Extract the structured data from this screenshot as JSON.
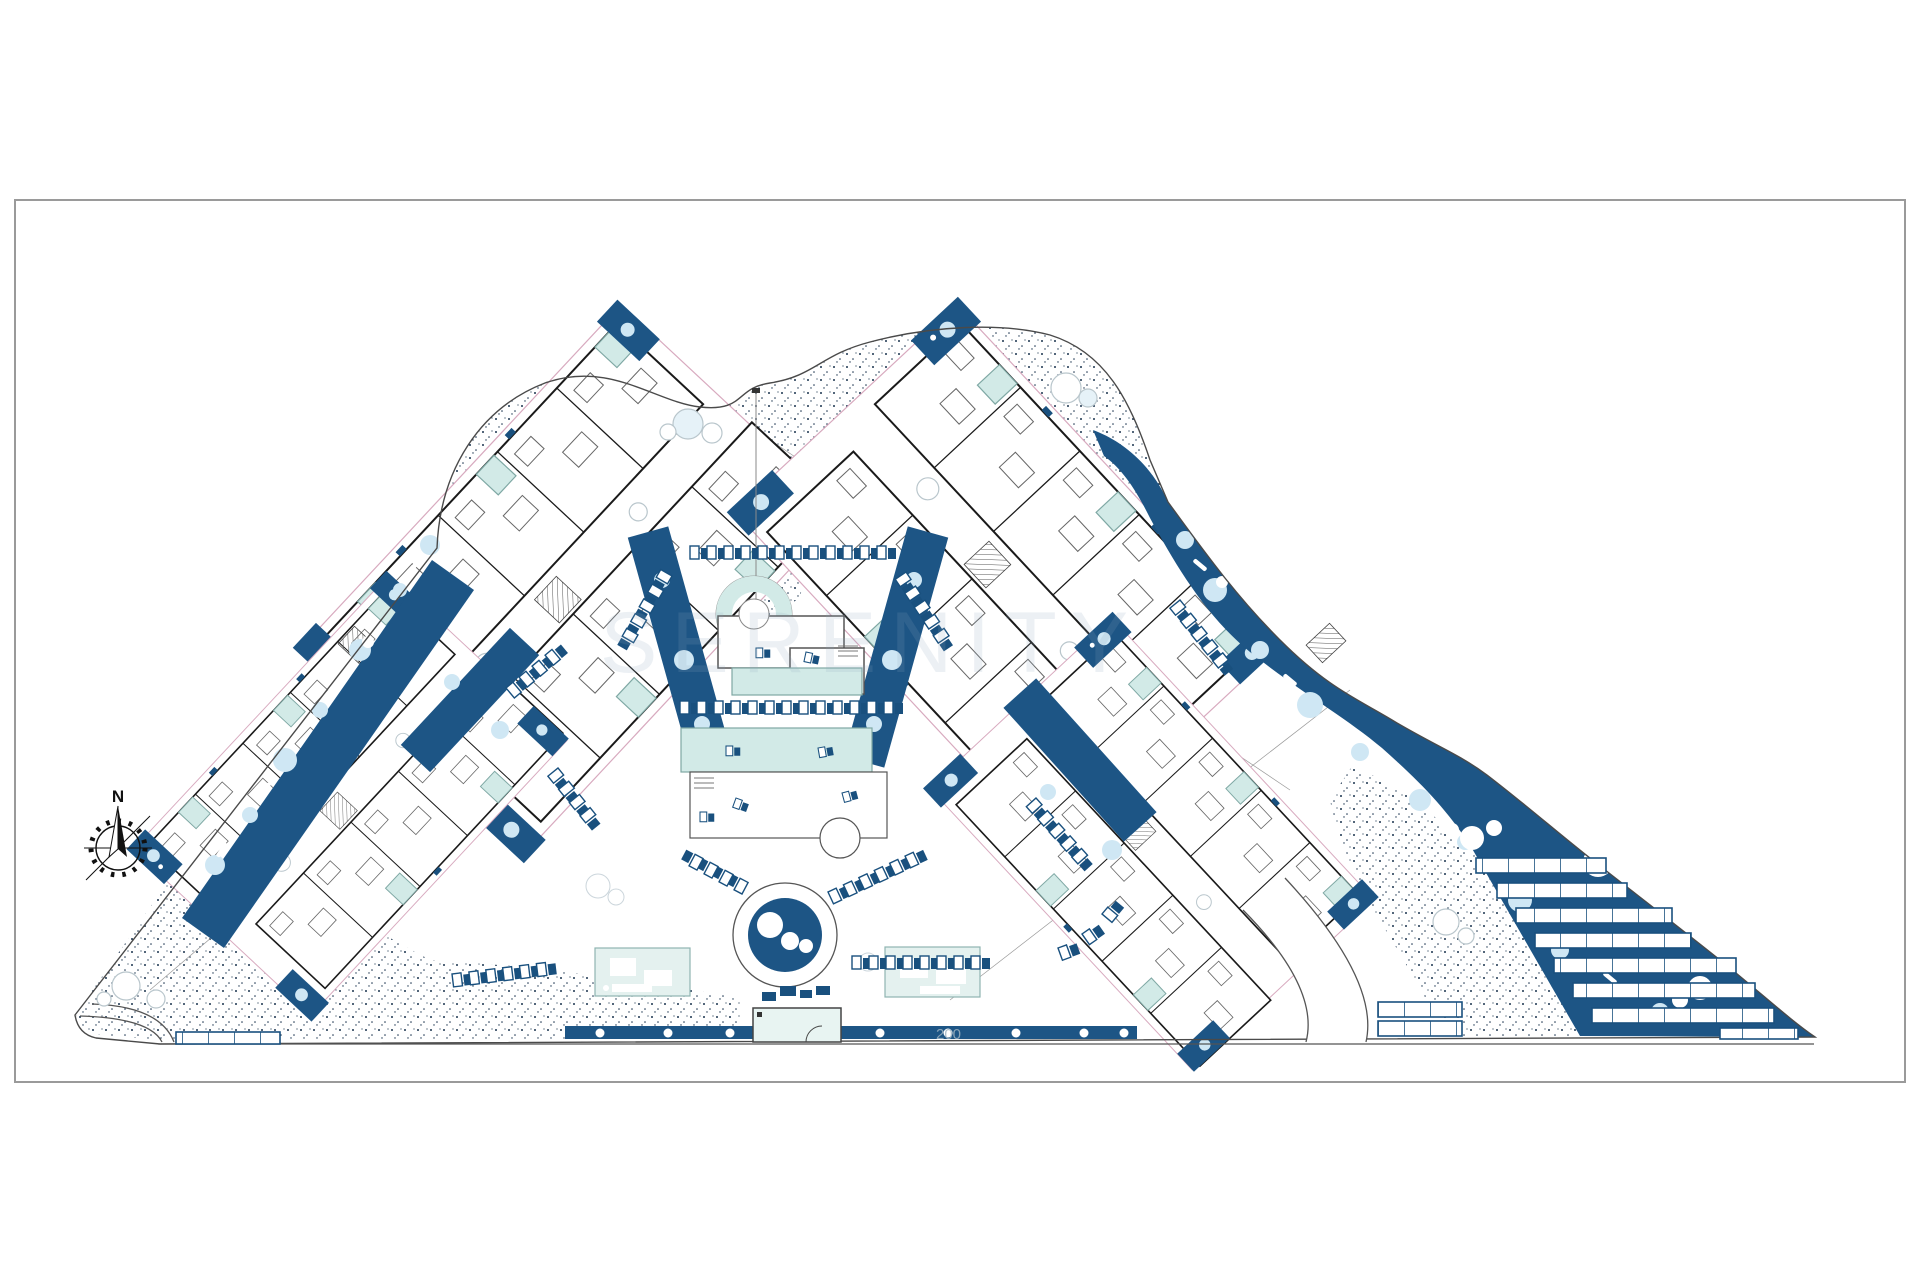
{
  "sheet": {
    "compass_label": "N",
    "watermark": "SERENITY",
    "road_marker": "200"
  },
  "colors": {
    "paper": "#ffffff",
    "border": "#9a9a9a",
    "ink": "#1a1a1a",
    "terrace": "#d8aabf",
    "blue": "#1d5585",
    "blue_deep": "#19507e",
    "shrub": "#cfe7f4",
    "pool": "#d2eae7",
    "pool_edge": "#7fa8a4",
    "stipple": "#1c3550",
    "tree_edge": "#b9c6cc",
    "wm": "#8fa7bd"
  },
  "parking": {
    "panel_rows": [
      5,
      5,
      6,
      6,
      7,
      7,
      7
    ],
    "partial_row": 3,
    "corner_rows": [
      3,
      3
    ],
    "street_stalls_left": 4
  }
}
